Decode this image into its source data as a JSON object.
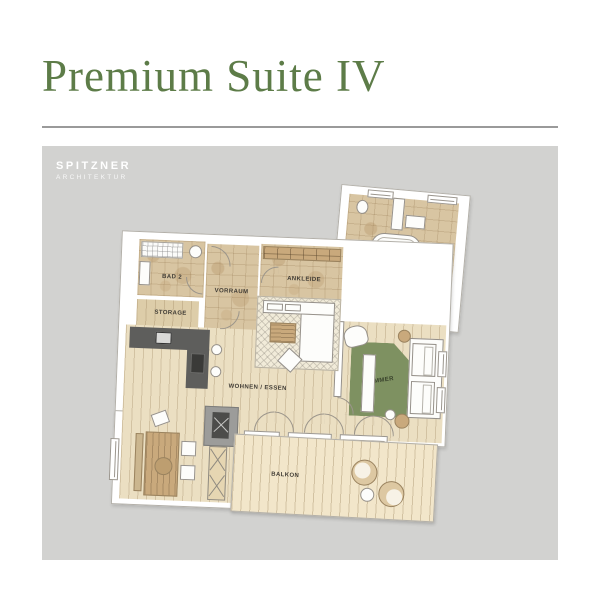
{
  "header": {
    "title": "Premium Suite IV"
  },
  "brand": {
    "name": "SPITZNER",
    "subtitle": "ARCHITEKTUR"
  },
  "floorplan": {
    "labels": {
      "bad2": "BAD 2",
      "storage": "STORAGE",
      "vorraum": "VORRAUM",
      "ankleide": "ANKLEIDE",
      "bad1": "BAD 1",
      "wohnen": "WOHNEN / ESSEN",
      "zimmer": "ZIMMER",
      "balkon": "BALKON"
    },
    "colors": {
      "accent_green": "#5d7c48",
      "panel_gray": "#d2d2d0",
      "stone_tile": "#d8c5a2",
      "wood_floor": "#ebdfc2",
      "deck_wood": "#f2e6ca",
      "rug_green": "#7e9161",
      "kitchen_dark": "#5e5e5c"
    }
  }
}
